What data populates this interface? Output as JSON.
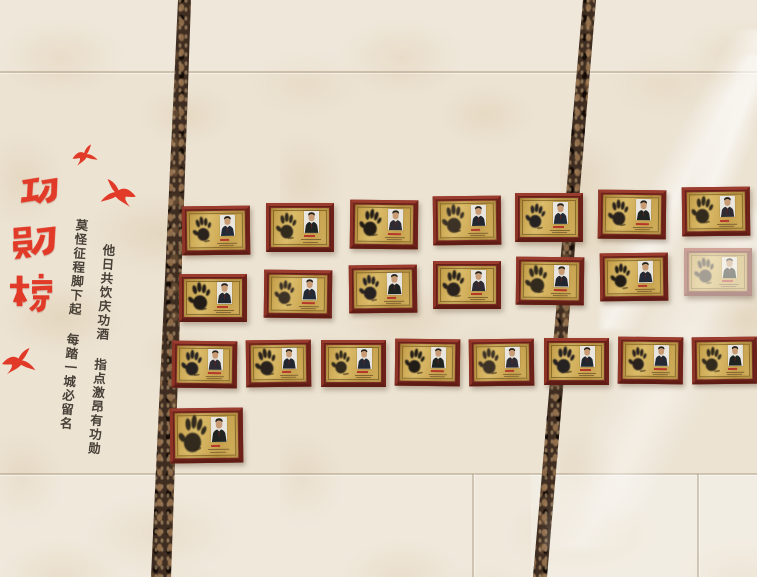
{
  "scene": {
    "description": "Photograph of a tiled honor wall with rows of framed gold handprint plaques",
    "interactive": false
  },
  "title": {
    "text": "功勋榜",
    "color": "#e23a28"
  },
  "couplet": {
    "line_right": "他日共饮庆功酒 指点激昂有功勋",
    "line_left": "莫怪征程脚下起 每踏一城必留名",
    "ink_color": "#3b332a"
  },
  "birds": [
    {
      "x": 70,
      "y": 143,
      "scale": 0.85,
      "flip": false,
      "rot": -12
    },
    {
      "x": 103,
      "y": 182,
      "scale": 1.2,
      "flip": true,
      "rot": 6
    },
    {
      "x": 4,
      "y": 350,
      "scale": 1.15,
      "flip": false,
      "rot": -4
    }
  ],
  "wall": {
    "tile_color": "#ece3d3",
    "strip_color": "#3e2d20",
    "seam_color": "rgba(150,128,100,0.35)"
  },
  "plaques": {
    "frame_color": "#7e2b21",
    "plate_color": "#cda955",
    "caption_color": "#b5382b",
    "hand_colors": [
      "#2a231c",
      "#33291f",
      "#211d19",
      "#3c3226",
      "#272220"
    ],
    "suit_colors": [
      "#242a35",
      "#1f2421",
      "#2e2b33",
      "#22262e"
    ],
    "rows": [
      {
        "y": 206,
        "slope": -3.2,
        "w": 68,
        "h": 49,
        "xs": [
          182,
          266,
          350,
          433,
          515,
          598,
          682
        ]
      },
      {
        "y": 274,
        "slope": -4.3,
        "w": 68,
        "h": 48,
        "xs": [
          179,
          264,
          349,
          433,
          516,
          600,
          684
        ],
        "washed": [
          6
        ]
      },
      {
        "y": 341,
        "slope": -0.6,
        "w": 65,
        "h": 47,
        "xs": [
          172,
          246,
          321,
          395,
          469,
          544,
          618,
          692
        ]
      },
      {
        "y": 408,
        "slope": 0,
        "w": 73,
        "h": 55,
        "xs": [
          170
        ],
        "hand_scale": 1.25
      }
    ]
  }
}
